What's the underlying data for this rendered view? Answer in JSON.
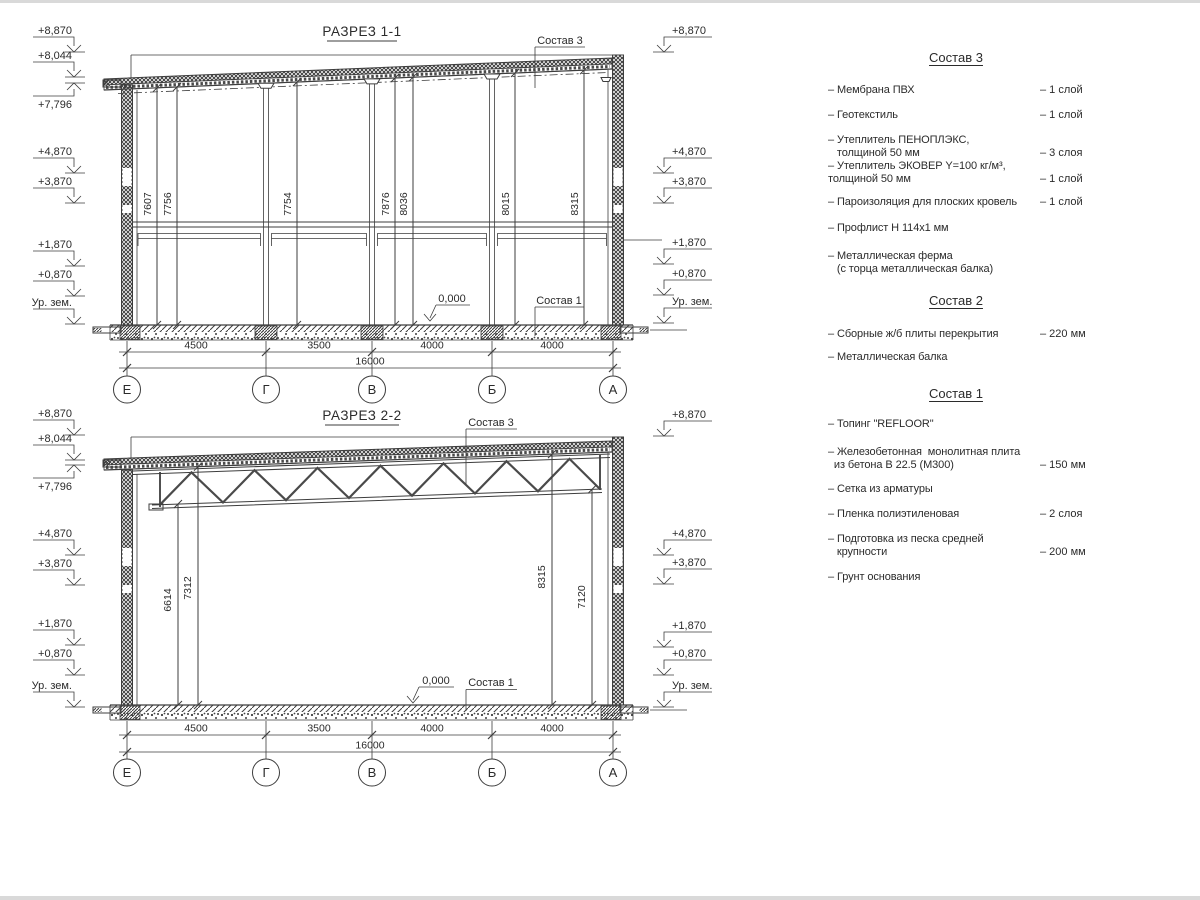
{
  "section_1_1": {
    "title": "РАЗРЕЗ 1-1",
    "elevations_left": [
      "+8,870",
      "+8,044",
      "+7,796",
      "+4,870",
      "+3,870",
      "+1,870",
      "+0,870",
      "Ур. зем."
    ],
    "elevations_right": [
      "+8,870",
      "+4,870",
      "+3,870",
      "+1,870",
      "+0,870",
      "Ур. зем."
    ],
    "vertical_dims": [
      "7607",
      "7756",
      "7754",
      "7876",
      "8036",
      "8015",
      "8315"
    ],
    "span_dims": [
      "4500",
      "3500",
      "4000",
      "4000"
    ],
    "total_dim": "16000",
    "grid_letters": [
      "Е",
      "Г",
      "В",
      "Б",
      "А"
    ],
    "labels": {
      "sostav_3": "Состав 3",
      "zero_level": "0,000",
      "sostav_1": "Состав 1"
    }
  },
  "section_2_2": {
    "title": "РАЗРЕЗ 2-2",
    "elevations_left": [
      "+8,870",
      "+8,044",
      "+7,796",
      "+4,870",
      "+3,870",
      "+1,870",
      "+0,870",
      "Ур. зем."
    ],
    "elevations_right": [
      "+8,870",
      "+4,870",
      "+3,870",
      "+1,870",
      "+0,870",
      "Ур. зем."
    ],
    "vertical_dims": [
      "6614",
      "7312",
      "8315",
      "7120"
    ],
    "span_dims": [
      "4500",
      "3500",
      "4000",
      "4000"
    ],
    "total_dim": "16000",
    "grid_letters": [
      "Е",
      "Г",
      "В",
      "Б",
      "А"
    ],
    "labels": {
      "sostav_3": "Состав 3",
      "zero_level": "0,000",
      "sostav_1": "Состав 1"
    }
  },
  "legend": {
    "groups": [
      {
        "title": "Состав 3",
        "items": [
          {
            "name": "– Мембрана ПВХ",
            "value": "– 1 слой"
          },
          {
            "name": "– Геотекстиль",
            "value": "– 1 слой"
          },
          {
            "name": "– Утеплитель ПЕНОПЛЭКС,\n   толщиной 50 мм",
            "value": "– 3 слоя"
          },
          {
            "name": "– Утеплитель ЭКОВЕР Y=100 кг/м³,\nтолщиной 50 мм",
            "value": "– 1 слой"
          },
          {
            "name": "– Пароизоляция для плоских кровель",
            "value": "– 1 слой"
          },
          {
            "name": "– Профлист Н 114х1 мм",
            "value": ""
          },
          {
            "name": "– Металлическая ферма\n   (с торца металлическая балка)",
            "value": ""
          }
        ]
      },
      {
        "title": "Состав 2",
        "items": [
          {
            "name": "– Сборные ж/б плиты перекрытия",
            "value": "– 220 мм"
          },
          {
            "name": "– Металлическая балка",
            "value": ""
          }
        ]
      },
      {
        "title": "Состав 1",
        "items": [
          {
            "name": "– Топинг \"REFLOOR\"",
            "value": ""
          },
          {
            "name": "– Железобетонная  монолитная плита\n  из бетона В 22.5 (М300)",
            "value": "– 150 мм"
          },
          {
            "name": "– Сетка из арматуры",
            "value": ""
          },
          {
            "name": "– Пленка полиэтиленовая",
            "value": "–  2 слоя"
          },
          {
            "name": "– Подготовка из песка средней\n   крупности",
            "value": "– 200 мм"
          },
          {
            "name": "– Грунт основания",
            "value": ""
          }
        ]
      }
    ]
  }
}
